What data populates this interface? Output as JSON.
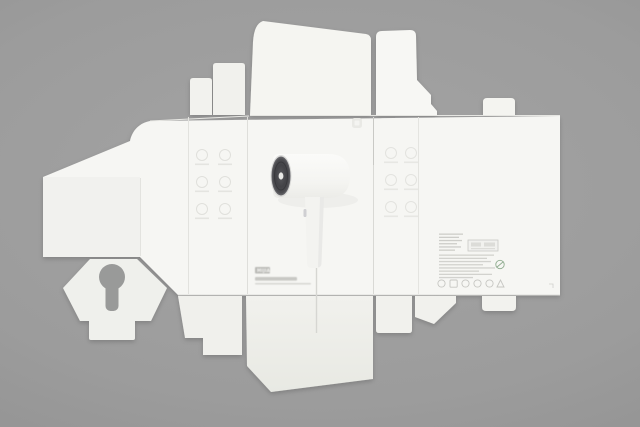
{
  "scene": {
    "description": "Unfolded white cardboard packaging dieline for a hair dryer, laid flat on a gray studio background",
    "background_color": "#9b9b9b"
  },
  "box": {
    "base_color": "#f5f5f2",
    "brand": {
      "logo_mark": "mi-home-rounded-square",
      "logo_wordmark": "MIJIA"
    },
    "front_panel": {
      "product_image": "white hair dryer, dark intake grille facing left, handle pointing down, cord line running downward",
      "intake_color": "#47474a"
    },
    "side_panels": {
      "left_icon_grid": {
        "rows": 3,
        "cols": 2,
        "style": "faint embossed feature icons with caption bars"
      },
      "right_icon_grid": {
        "rows": 3,
        "cols": 2,
        "style": "faint embossed feature icons with caption bars"
      }
    },
    "back_panel": {
      "fine_print_lines_left_column": 6,
      "fine_print_lines_wide": 8,
      "barcode_box": true,
      "green_stamp_color": "#8fac8f",
      "certification_icons_count": 6
    },
    "bottom_left_print": {
      "wordmark_chip": "MIJIA",
      "product_name_bar": "illegible small product name line",
      "underline_bar": "illegible smaller sub-line"
    },
    "cutouts": {
      "hang_hole": "keyhole-shaped cutout in lower-left flap"
    }
  }
}
